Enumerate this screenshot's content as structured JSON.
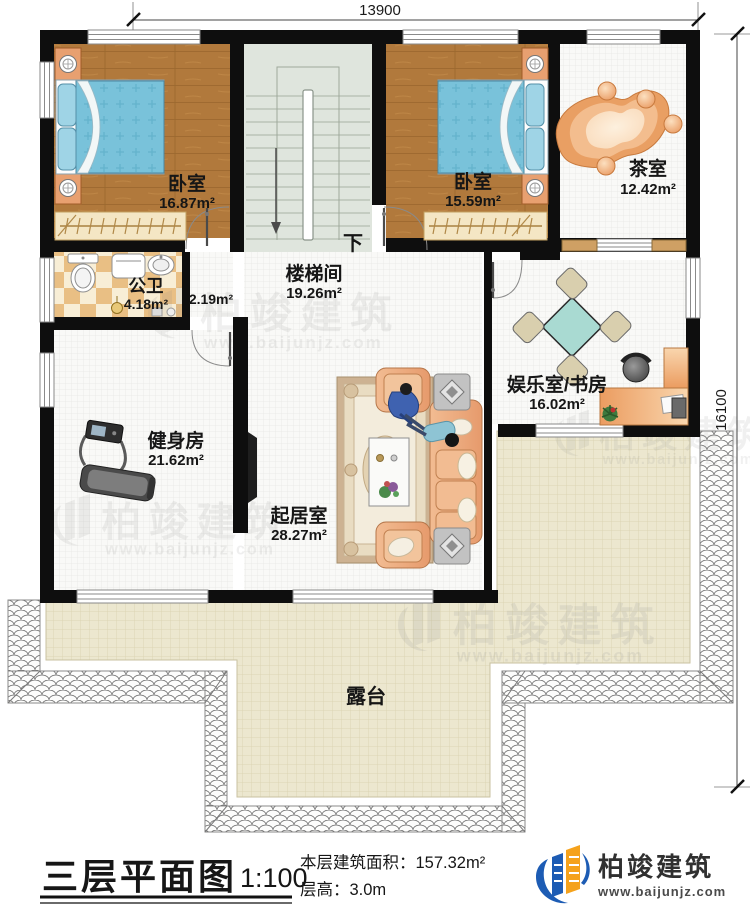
{
  "dimensions": {
    "top": "13900",
    "right": "16100"
  },
  "rooms": {
    "bedroom1": {
      "name": "卧室",
      "area": "16.87m²"
    },
    "bedroom2": {
      "name": "卧室",
      "area": "15.59m²"
    },
    "tea_room": {
      "name": "茶室",
      "area": "12.42m²"
    },
    "stair_hall": {
      "name": "楼梯间",
      "area": "19.26m²"
    },
    "bathroom": {
      "name": "公卫",
      "area": "4.18m²"
    },
    "corridor": {
      "area": "2.19m²"
    },
    "gym": {
      "name": "健身房",
      "area": "21.62m²"
    },
    "living_room": {
      "name": "起居室",
      "area": "28.27m²"
    },
    "entertainment_study": {
      "name": "娱乐室/书房",
      "area": "16.02m²"
    },
    "terrace": {
      "name": "露台"
    }
  },
  "stairs": {
    "direction_label": "下"
  },
  "title_block": {
    "plan_title": "三层平面图",
    "scale": "1:100",
    "floor_area_label": "本层建筑面积：",
    "floor_area_value": "157.32m²",
    "floor_height_label": "层高：",
    "floor_height_value": "3.0m",
    "brand_name": "柏竣建筑",
    "brand_url": "www.baijunjz.com"
  },
  "watermark": {
    "name": "柏竣建筑",
    "url": "www.baijunjz.com"
  }
}
